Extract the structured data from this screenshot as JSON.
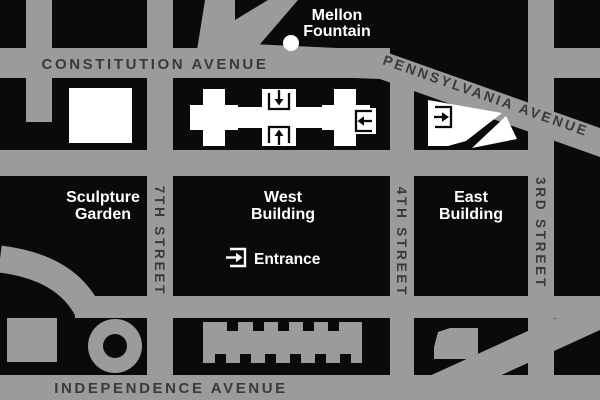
{
  "map": {
    "street_labels": {
      "constitution": "CONSTITUTION AVENUE",
      "pennsylvania": "PENNSYLVANIA AVENUE",
      "independence": "INDEPENDENCE AVENUE",
      "seventh": "7TH STREET",
      "fourth": "4TH STREET",
      "third": "3RD STREET"
    },
    "place_labels": {
      "mellon_1": "Mellon",
      "mellon_2": "Fountain",
      "sculpture_1": "Sculpture",
      "sculpture_2": "Garden",
      "west_1": "West",
      "west_2": "Building",
      "east_1": "East",
      "east_2": "Building",
      "entrance": "Entrance"
    },
    "icons": {
      "west_top_entrance": "arrow-down-into-bracket",
      "west_bottom_entrance": "arrow-up-into-bracket",
      "west_right_entrance": "arrow-left-into-bracket",
      "east_entrance": "arrow-right-into-bracket",
      "entrance_legend": "arrow-right-into-bracket",
      "mellon_fountain": "white-dot"
    },
    "colors": {
      "background": "#0a0a0b",
      "street": "#9b9b9b",
      "street_text": "#3a3a3c",
      "building_white": "#ffffff",
      "label_white": "#ffffff"
    }
  }
}
